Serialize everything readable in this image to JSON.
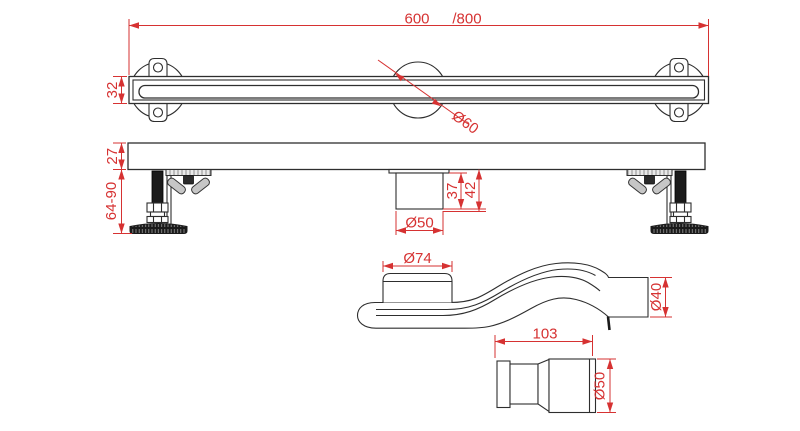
{
  "drawing": {
    "description": "Linear shower drain technical drawing with four orthographic views",
    "background_color": "#ffffff",
    "line_color": "#2e2e2e",
    "dimension_color": "#d63232",
    "views": {
      "top": {
        "label": "top-view",
        "dims": {
          "length": "600",
          "length_alt": "/800",
          "height": "32",
          "waste_diameter": "Ø60"
        }
      },
      "front": {
        "label": "front-view",
        "dims": {
          "body_height": "27",
          "foot_height": "64-90",
          "spigot_depth": "37",
          "spigot_total_depth": "42",
          "spigot_diameter": "Ø50"
        }
      },
      "trap": {
        "label": "trap-side-view",
        "dims": {
          "inlet_diameter": "Ø74",
          "outlet_diameter": "Ø40"
        }
      },
      "coupling": {
        "label": "coupling-view",
        "dims": {
          "length": "103",
          "diameter": "Ø50"
        }
      }
    }
  }
}
